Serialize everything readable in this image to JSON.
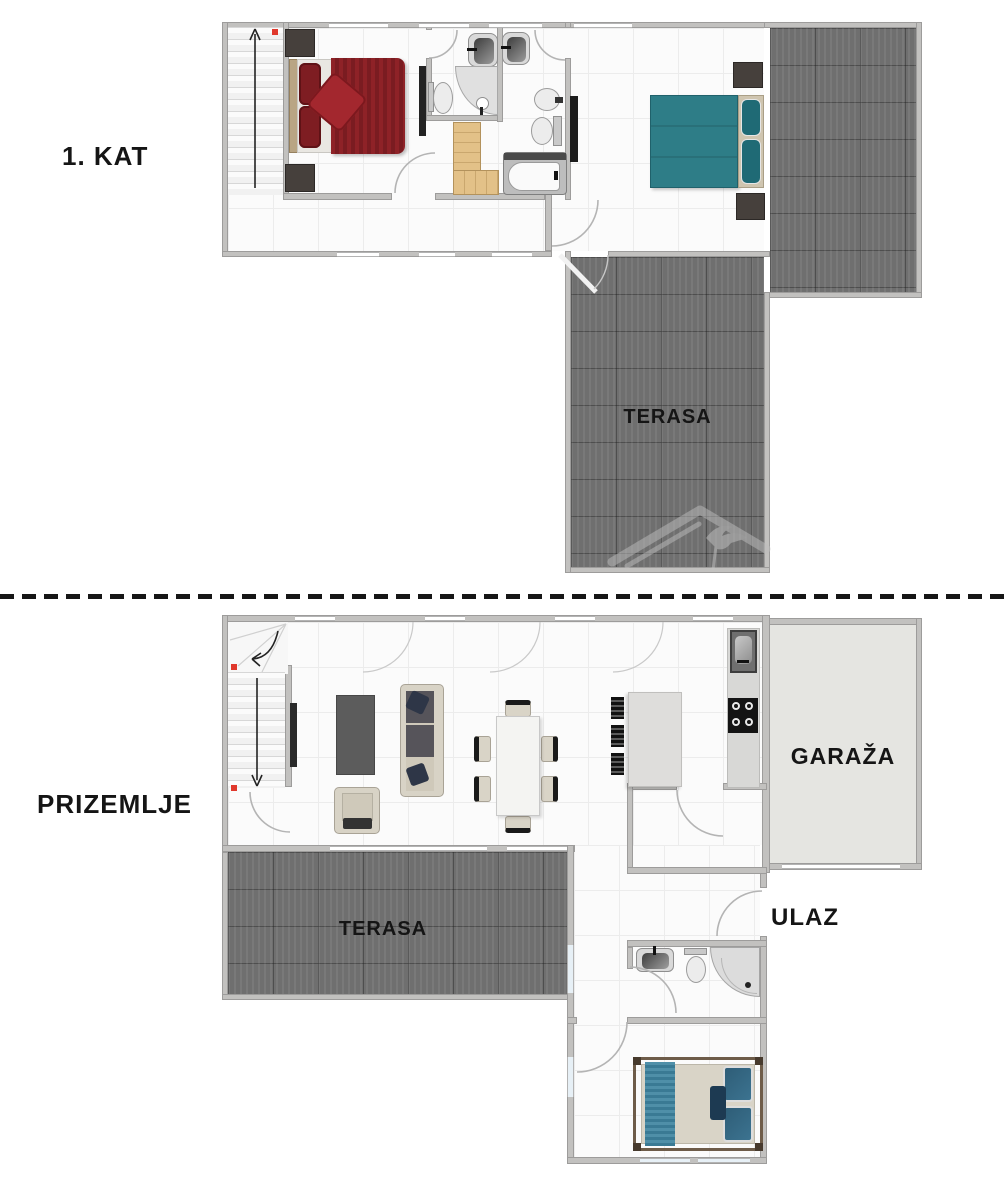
{
  "floor_plan": {
    "upper": {
      "name_label": "1. KAT",
      "terrace_label": "TERASA"
    },
    "ground": {
      "name_label": "PRIZEMLJE",
      "terrace_label": "TERASA",
      "garage_label": "GARAŽA",
      "entrance_label": "ULAZ"
    }
  },
  "colors": {
    "wall": "#c2c1bf",
    "floor_line": "#ececec",
    "terrace_tile": "#6f6f6f",
    "garage_floor": "#e5e5e1",
    "bed_red": "#8e2227",
    "bed_teal": "#2e7d87",
    "bed_runner_teal": "#4f8fa8",
    "wood": "#e3c188",
    "red_dot": "#e0382c",
    "label_text": "#151515",
    "sofa_beige": "#d8d3c6",
    "dark_furniture": "#46403c"
  }
}
